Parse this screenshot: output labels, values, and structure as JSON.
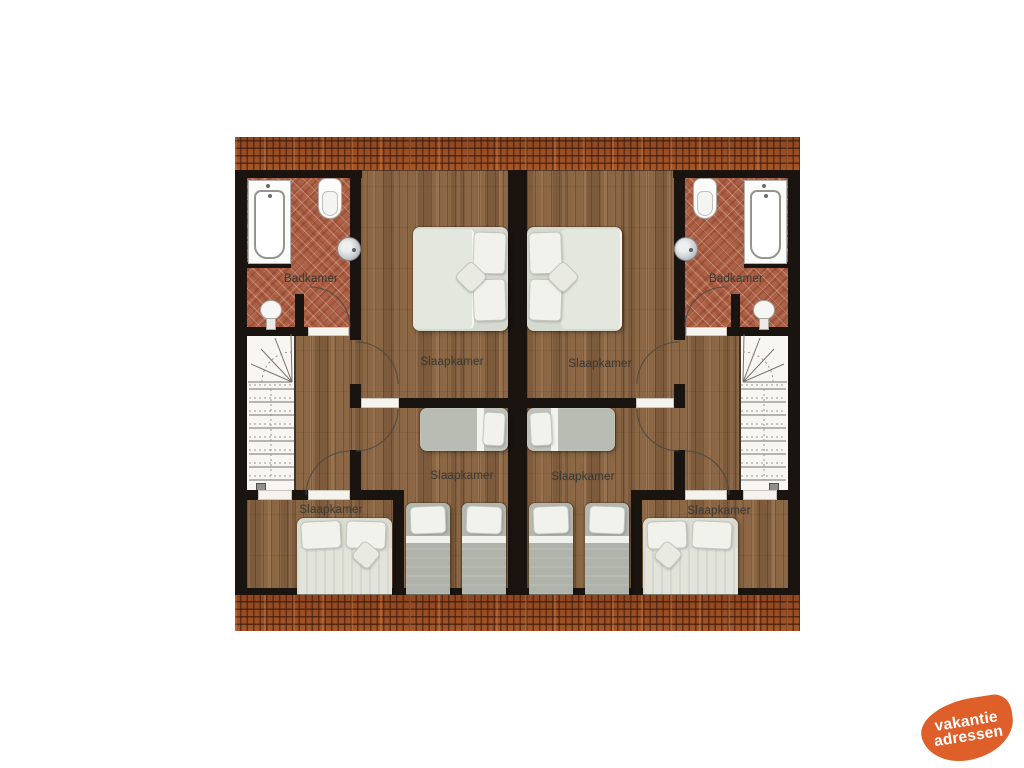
{
  "page": {
    "background_color": "#ffffff"
  },
  "floorplan": {
    "room_labels": [
      {
        "id": "badkamer-left",
        "label": "Badkamer"
      },
      {
        "id": "badkamer-right",
        "label": "Badkamer"
      },
      {
        "id": "slaapkamer-master-left",
        "label": "Slaapkamer"
      },
      {
        "id": "slaapkamer-master-right",
        "label": "Slaapkamer"
      },
      {
        "id": "slaapkamer-middle-left",
        "label": "Slaapkamer"
      },
      {
        "id": "slaapkamer-middle-right",
        "label": "Slaapkamer"
      },
      {
        "id": "slaapkamer-bottom-left",
        "label": "Slaapkamer"
      },
      {
        "id": "slaapkamer-bottom-right",
        "label": "Slaapkamer"
      }
    ],
    "colors": {
      "wall": "#191410",
      "wood_floor": "#8b6745",
      "brick_floor": "#ad6147",
      "roof_tiles": "#a0522a",
      "bed_linen": "#e4e7de"
    }
  },
  "logo": {
    "line1": "vakantie",
    "line2": "adressen",
    "background_color": "#de5f2a",
    "text_color": "#ffffff"
  }
}
